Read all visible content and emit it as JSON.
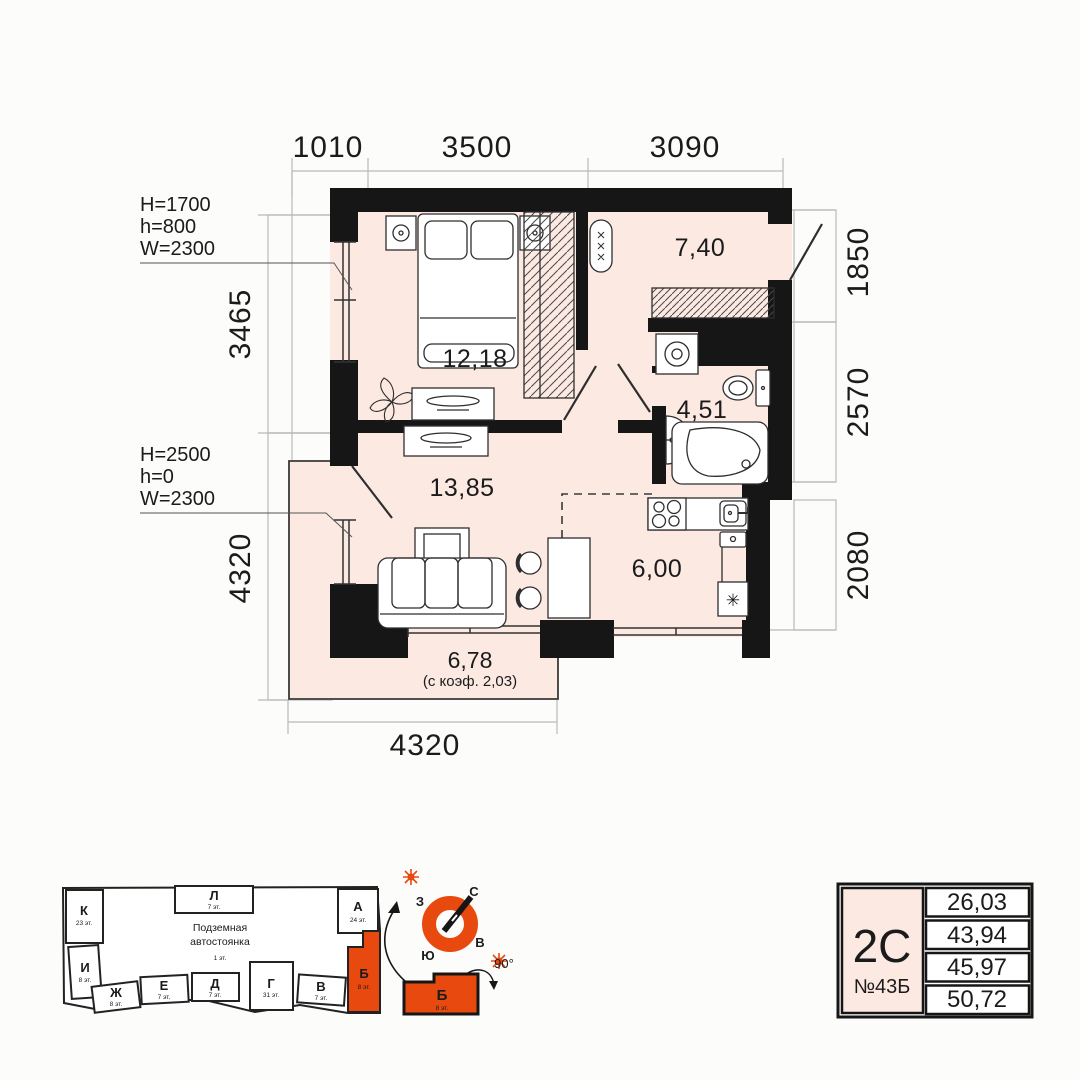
{
  "plan": {
    "dims": {
      "top": [
        "1010",
        "3500",
        "3090"
      ],
      "left": [
        "3465",
        "4320"
      ],
      "right": [
        "1850",
        "2570",
        "2080"
      ],
      "bottom": "4320"
    },
    "window_specs": {
      "first": [
        "H=1700",
        "h=800",
        "W=2300"
      ],
      "second": [
        "H=2500",
        "h=0",
        "W=2300"
      ]
    },
    "rooms": {
      "bedroom": "12,18",
      "hall": "7,40",
      "bath": "4,51",
      "living": "13,85",
      "kitchen": "6,00",
      "balcony": "6,78",
      "balcony_note": "(с коэф. 2,03)"
    }
  },
  "site": {
    "parking_line1": "Подземная",
    "parking_line2": "автостоянка",
    "parking_floors": "1 эт.",
    "sections": {
      "K": {
        "label": "К",
        "floors": "23 эт."
      },
      "L": {
        "label": "Л",
        "floors": "7 эт."
      },
      "A": {
        "label": "А",
        "floors": "24 эт."
      },
      "I": {
        "label": "И",
        "floors": "8 эт."
      },
      "Zh": {
        "label": "Ж",
        "floors": "8 эт."
      },
      "E": {
        "label": "Е",
        "floors": "7 эт."
      },
      "D": {
        "label": "Д",
        "floors": "7 эт."
      },
      "G": {
        "label": "Г",
        "floors": "31 эт."
      },
      "V": {
        "label": "В",
        "floors": "7 эт."
      },
      "B": {
        "label": "Б",
        "floors": "8 эт."
      }
    }
  },
  "compass": {
    "north": "С",
    "south": "Ю",
    "west": "З",
    "east": "В",
    "angle": "90°",
    "section_label": "Б",
    "section_floors": "8 эт."
  },
  "card": {
    "type": "2С",
    "number": "№43Б",
    "values": [
      "26,03",
      "43,94",
      "45,97",
      "50,72"
    ]
  },
  "colors": {
    "accent": "#e8490f",
    "room_fill": "#fbe9e2",
    "wall": "#161616"
  }
}
